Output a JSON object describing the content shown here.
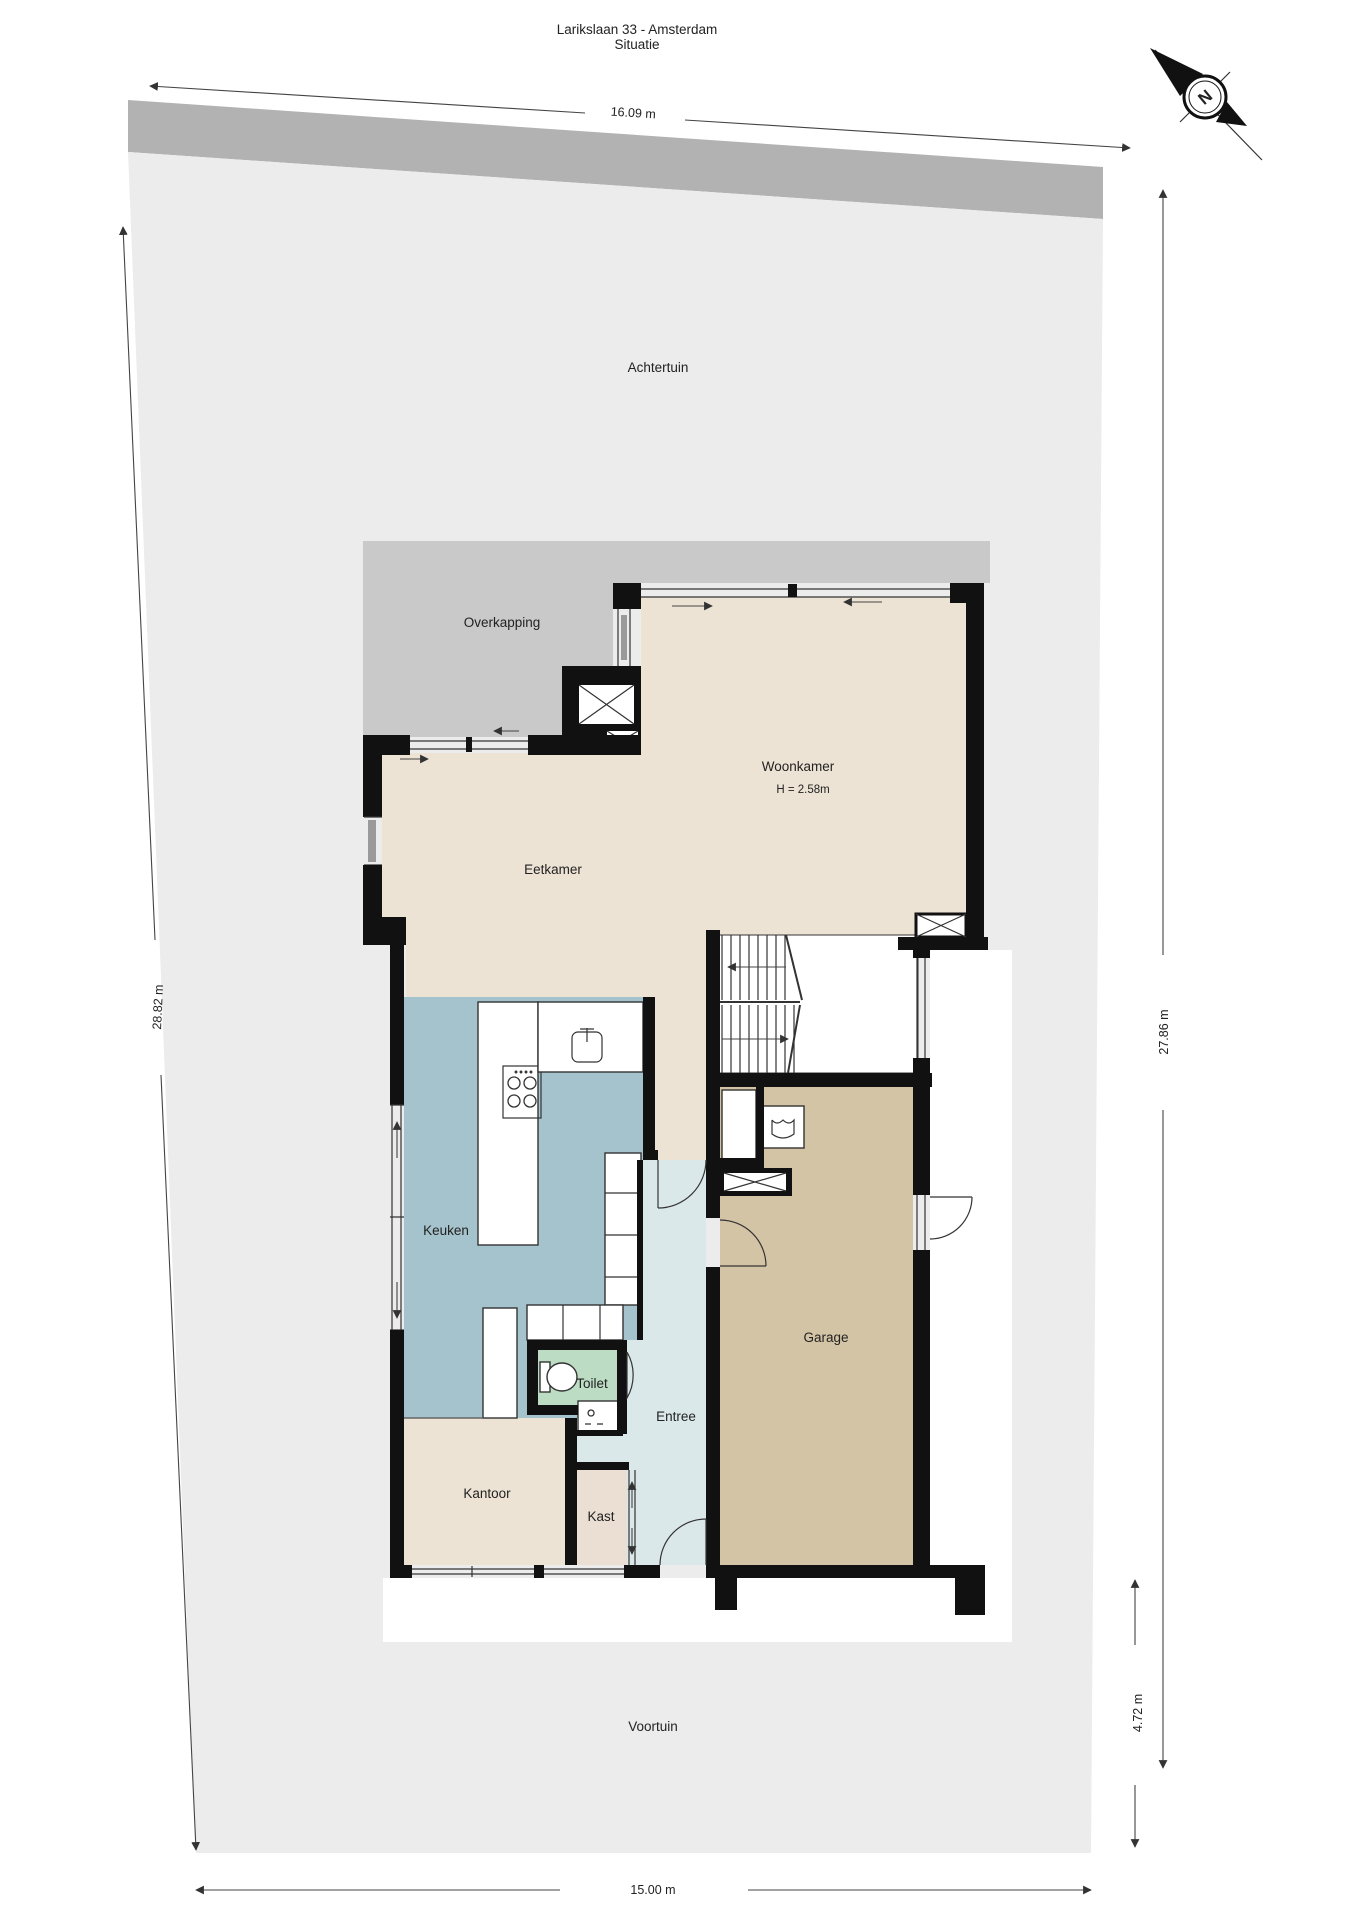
{
  "title": {
    "line1": "Larikslaan 33 - Amsterdam",
    "line2": "Situatie"
  },
  "compass": {
    "north_label": "N"
  },
  "dimensions": {
    "plot_top_width": "16.09 m",
    "plot_left_depth": "28.82 m",
    "plot_right_depth": "27.86 m",
    "front_garden_depth": "4.72 m",
    "plot_bottom_width": "15.00 m"
  },
  "areas": {
    "back_garden": "Achtertuin",
    "canopy": "Overkapping",
    "front_garden": "Voortuin"
  },
  "rooms": {
    "living": {
      "label": "Woonkamer",
      "height_note": "H = 2.58m"
    },
    "dining": {
      "label": "Eetkamer"
    },
    "kitchen": {
      "label": "Keuken"
    },
    "toilet": {
      "label": "Toilet"
    },
    "hall": {
      "label": "Entree"
    },
    "office": {
      "label": "Kantoor"
    },
    "closet": {
      "label": "Kast"
    },
    "garage": {
      "label": "Garage"
    }
  },
  "colors": {
    "plot": "#ececec",
    "road_strip": "#b2b2b2",
    "canopy": "#c9c9c9",
    "living_floor": "#ede3d5",
    "kitchen_floor": "#a5c3cc",
    "toilet_floor": "#bcdcc4",
    "hall_floor": "#dbe8ea",
    "garage_floor": "#d4c4a6",
    "walls": "#111111"
  }
}
